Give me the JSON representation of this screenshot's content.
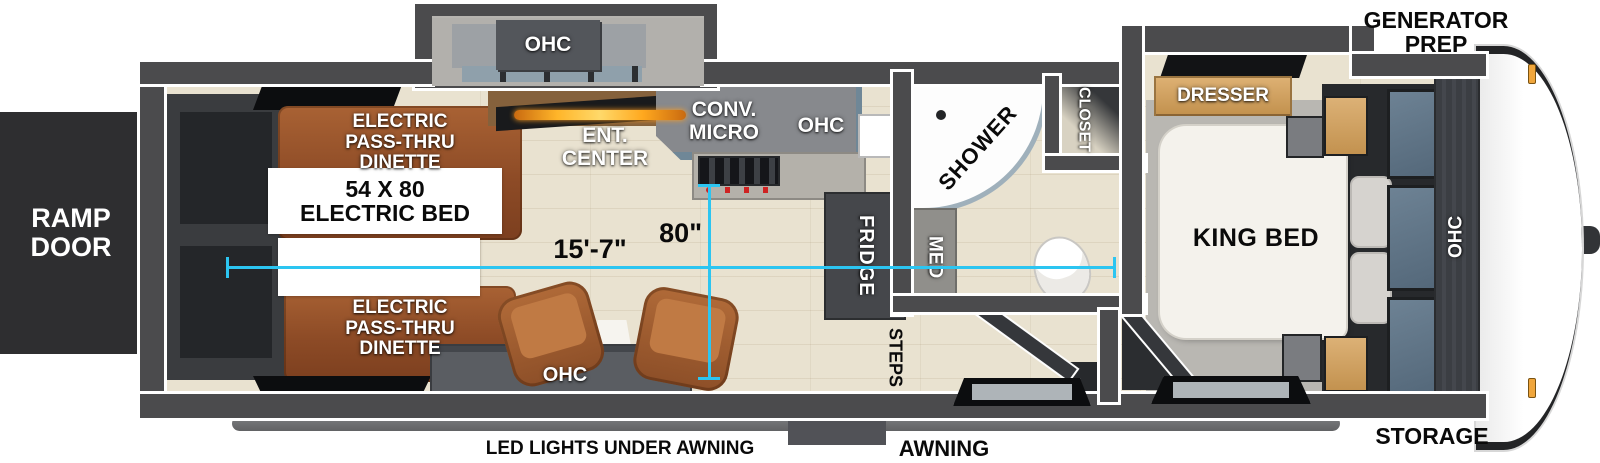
{
  "colors": {
    "accent_cyan": "#2cc5f1",
    "wall": "#4b4b4d",
    "wood_floor": "#e9e2d0",
    "sofa_brown": "#9a5730",
    "cabinet_gray": "#87898d",
    "dark_unit": "#45474b",
    "dresser_wood": "#d2a265",
    "ramp_black": "#2e2e30"
  },
  "exterior": {
    "generator_prep": "GENERATOR\nPREP",
    "ramp_door": "RAMP\nDOOR",
    "storage": "STORAGE",
    "awning": "AWNING",
    "led_lights": "LED LIGHTS UNDER AWNING"
  },
  "garage": {
    "ohc_slide": "OHC",
    "dinette_top": "ELECTRIC\nPASS-THRU\nDINETTE",
    "dinette_bottom": "ELECTRIC\nPASS-THRU\nDINETTE",
    "electric_bed": "54 X 80\nELECTRIC BED",
    "ent_center": "ENT.\nCENTER",
    "ohc_bottom": "OHC"
  },
  "kitchen": {
    "conv_micro": "CONV.\nMICRO",
    "ohc": "OHC",
    "fridge": "FRIDGE"
  },
  "bath": {
    "shower": "SHOWER",
    "med": "MED",
    "closet": "CLOSET"
  },
  "entry": {
    "steps": "STEPS"
  },
  "bedroom": {
    "dresser": "DRESSER",
    "king_bed": "KING BED",
    "ohc": "OHC"
  },
  "measurements": {
    "length": "15'-7\"",
    "width": "80\""
  }
}
